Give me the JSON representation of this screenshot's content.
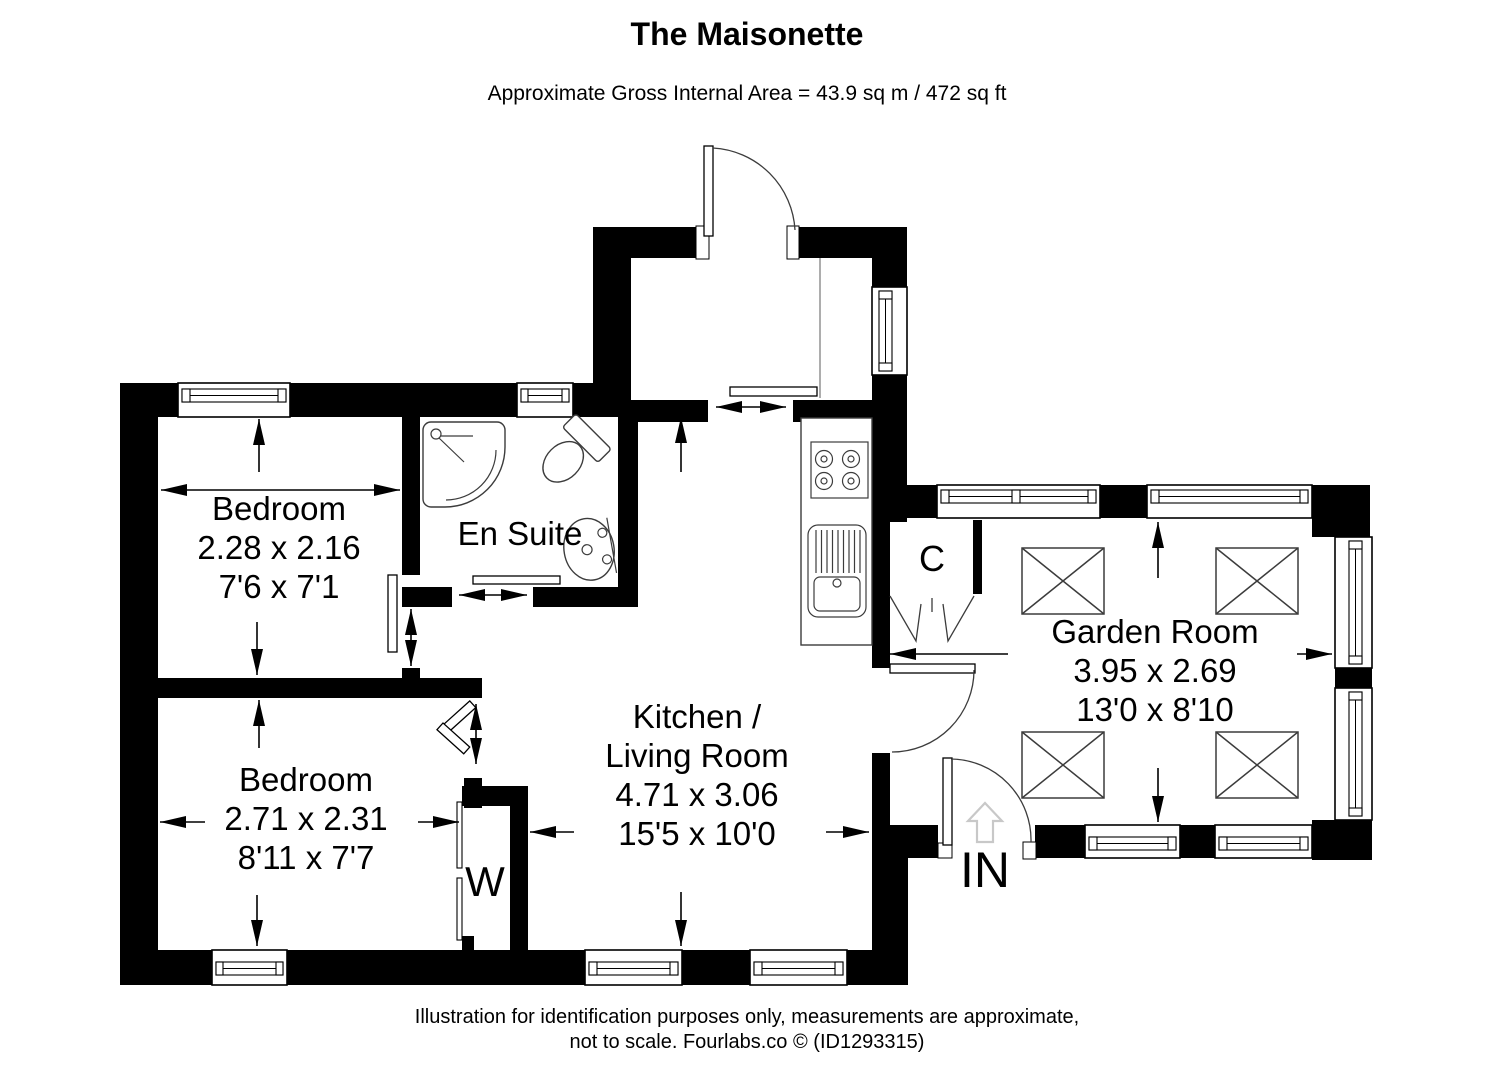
{
  "header": {
    "title": "The Maisonette",
    "subtitle": "Approximate Gross Internal Area = 43.9 sq m / 472 sq ft"
  },
  "rooms": {
    "bedroom1": {
      "name": "Bedroom",
      "metric": "2.28 x 2.16",
      "imperial": "7'6 x 7'1"
    },
    "ensuite": {
      "name": "En Suite"
    },
    "bedroom2": {
      "name": "Bedroom",
      "metric": "2.71 x 2.31",
      "imperial": "8'11 x 7'7"
    },
    "kitchen_living": {
      "line1": "Kitchen /",
      "line2": "Living Room",
      "metric": "4.71 x 3.06",
      "imperial": "15'5 x 10'0"
    },
    "garden_room": {
      "name": "Garden Room",
      "metric": "3.95 x 2.69",
      "imperial": "13'0 x 8'10"
    }
  },
  "labels": {
    "cupboard": "C",
    "wardrobe": "W",
    "entrance": "IN"
  },
  "footer": {
    "line1": "Illustration for identification purposes only, measurements are approximate,",
    "line2": "not to scale. Fourlabs.co © (ID1293315)"
  },
  "theme": {
    "wall_color": "#000000",
    "line_color": "#3c3c3c",
    "entry_arrow_color": "#c8c8c8",
    "background": "#ffffff",
    "text_color": "#000000"
  }
}
